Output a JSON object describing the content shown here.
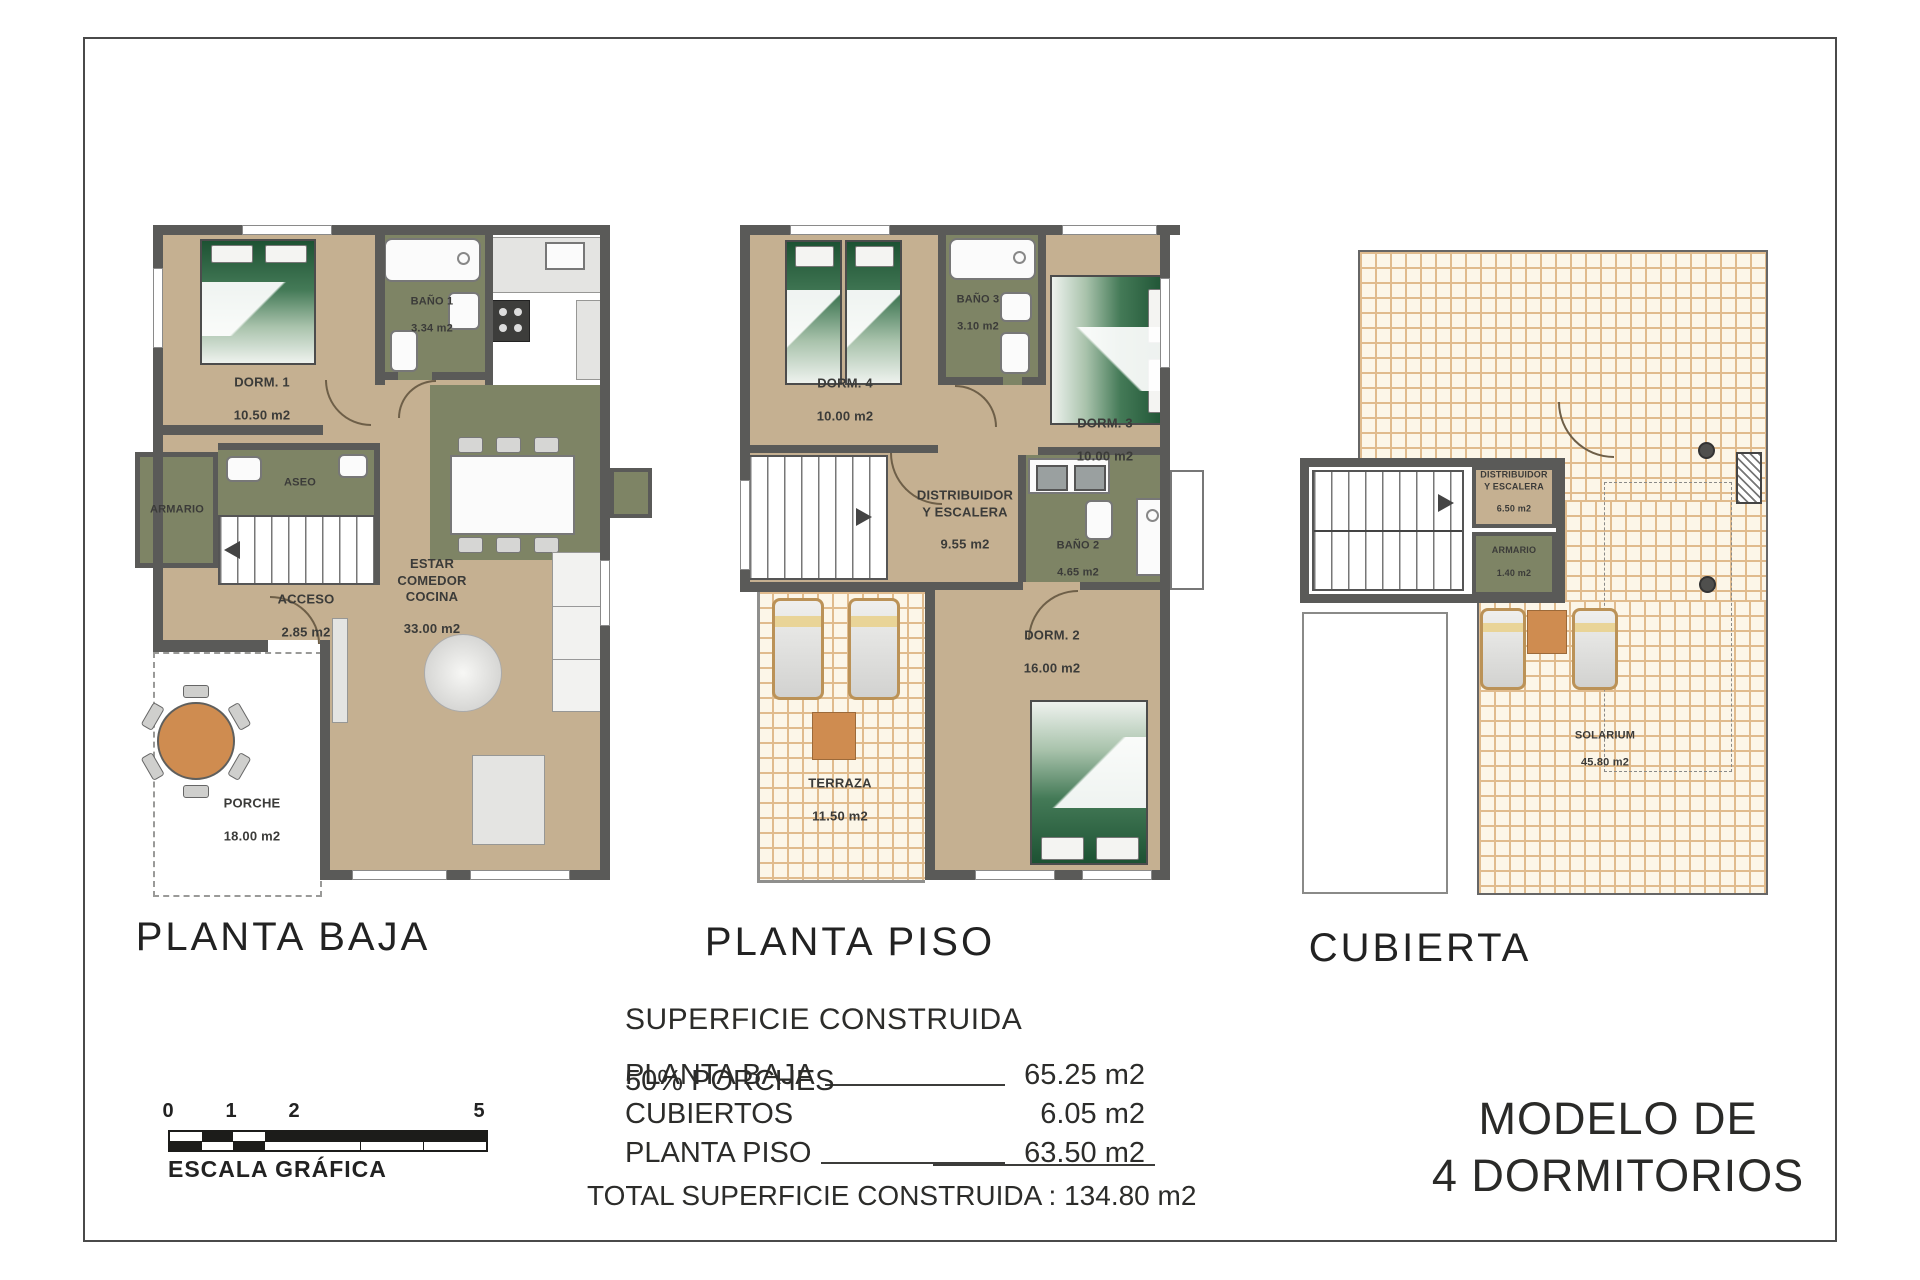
{
  "plans": {
    "baja": {
      "title": "PLANTA BAJA",
      "rooms": {
        "dorm1": {
          "name": "DORM. 1",
          "area": "10.50 m2"
        },
        "bano1": {
          "name": "BAÑO 1",
          "area": "3.34 m2"
        },
        "armario": {
          "name": "ARMARIO",
          "area": ""
        },
        "aseo": {
          "name": "ASEO",
          "area": ""
        },
        "acceso": {
          "name": "ACCESO",
          "area": "2.85 m2"
        },
        "estar": {
          "name": "ESTAR\nCOMEDOR\nCOCINA",
          "area": "33.00 m2"
        },
        "porche": {
          "name": "PORCHE",
          "area": "18.00 m2"
        }
      }
    },
    "piso": {
      "title": "PLANTA PISO",
      "rooms": {
        "dorm4": {
          "name": "DORM. 4",
          "area": "10.00 m2"
        },
        "bano3": {
          "name": "BAÑO 3",
          "area": "3.10 m2"
        },
        "dorm3": {
          "name": "DORM. 3",
          "area": "10.00 m2"
        },
        "distribuidor": {
          "name": "DISTRIBUIDOR\nY ESCALERA",
          "area": "9.55 m2"
        },
        "bano2": {
          "name": "BAÑO 2",
          "area": "4.65 m2"
        },
        "dorm2": {
          "name": "DORM. 2",
          "area": "16.00 m2"
        },
        "terraza": {
          "name": "TERRAZA",
          "area": "11.50 m2"
        }
      }
    },
    "cubierta": {
      "title": "CUBIERTA",
      "rooms": {
        "distribuidor": {
          "name": "DISTRIBUIDOR\nY ESCALERA",
          "area": "6.50 m2"
        },
        "armario": {
          "name": "ARMARIO",
          "area": "1.40 m2"
        },
        "solarium": {
          "name": "SOLARIUM",
          "area": "45.80 m2"
        }
      }
    }
  },
  "summary": {
    "title": "SUPERFICIE CONSTRUIDA",
    "rows": [
      {
        "label": "PLANTA BAJA",
        "value": "65.25 m2"
      },
      {
        "label": "50% PORCHES CUBIERTOS",
        "value": "6.05 m2"
      },
      {
        "label": "PLANTA PISO",
        "value": "63.50 m2"
      }
    ],
    "total_label": "TOTAL SUPERFICIE CONSTRUIDA :",
    "total_value": "134.80 m2"
  },
  "scale_bar": {
    "ticks": [
      "0",
      "1",
      "2",
      "5"
    ],
    "label": "ESCALA GRÁFICA"
  },
  "model": {
    "line1": "MODELO DE",
    "line2": "4 DORMITORIOS"
  },
  "colors": {
    "wall": "#5a5a58",
    "room_beige": "#c5b091",
    "room_olive": "#7e8465",
    "tile_line": "#e0bb8d",
    "accent_orange": "#cf8c50",
    "bed_green": "#1d5233"
  }
}
